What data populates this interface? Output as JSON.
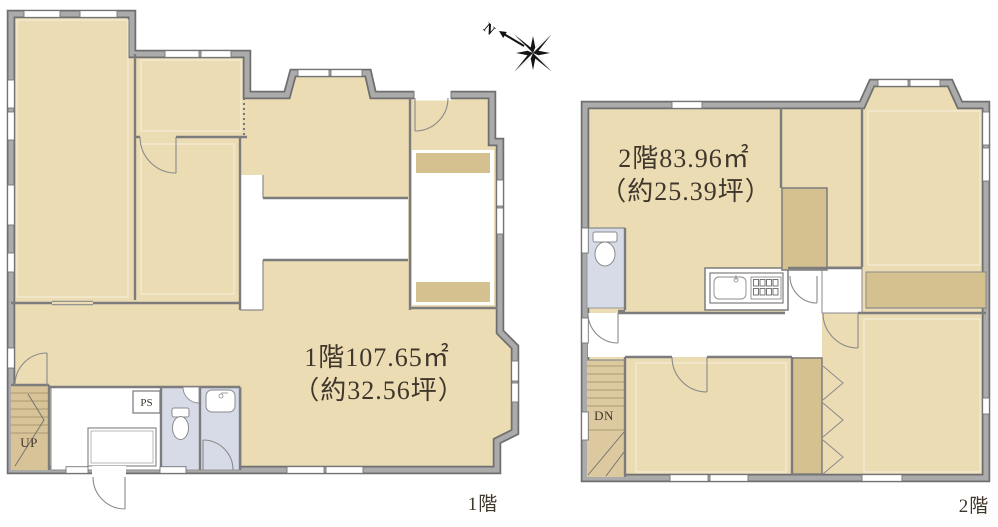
{
  "title": "Floor plan drawing, 1st and 2nd floor",
  "floor1": {
    "area_line1": "1階107.65㎡",
    "area_line2": "（約32.56坪）",
    "caption": "1階",
    "stairs_label": "UP",
    "pipe_space_label": "PS"
  },
  "floor2": {
    "area_line1": "2階83.96㎡",
    "area_line2": "（約25.39坪）",
    "caption": "2階",
    "stairs_label": "DN"
  },
  "compass": {
    "north_label": "N"
  },
  "colors": {
    "floor": "#ecdcb4",
    "closet": "#d5c190",
    "stair_hall": "#d8c398",
    "wet_room": "#d7dbe8",
    "wall_edge": "#6f6f6f",
    "wall_fill": "#ababab",
    "text": "#3f372b"
  }
}
